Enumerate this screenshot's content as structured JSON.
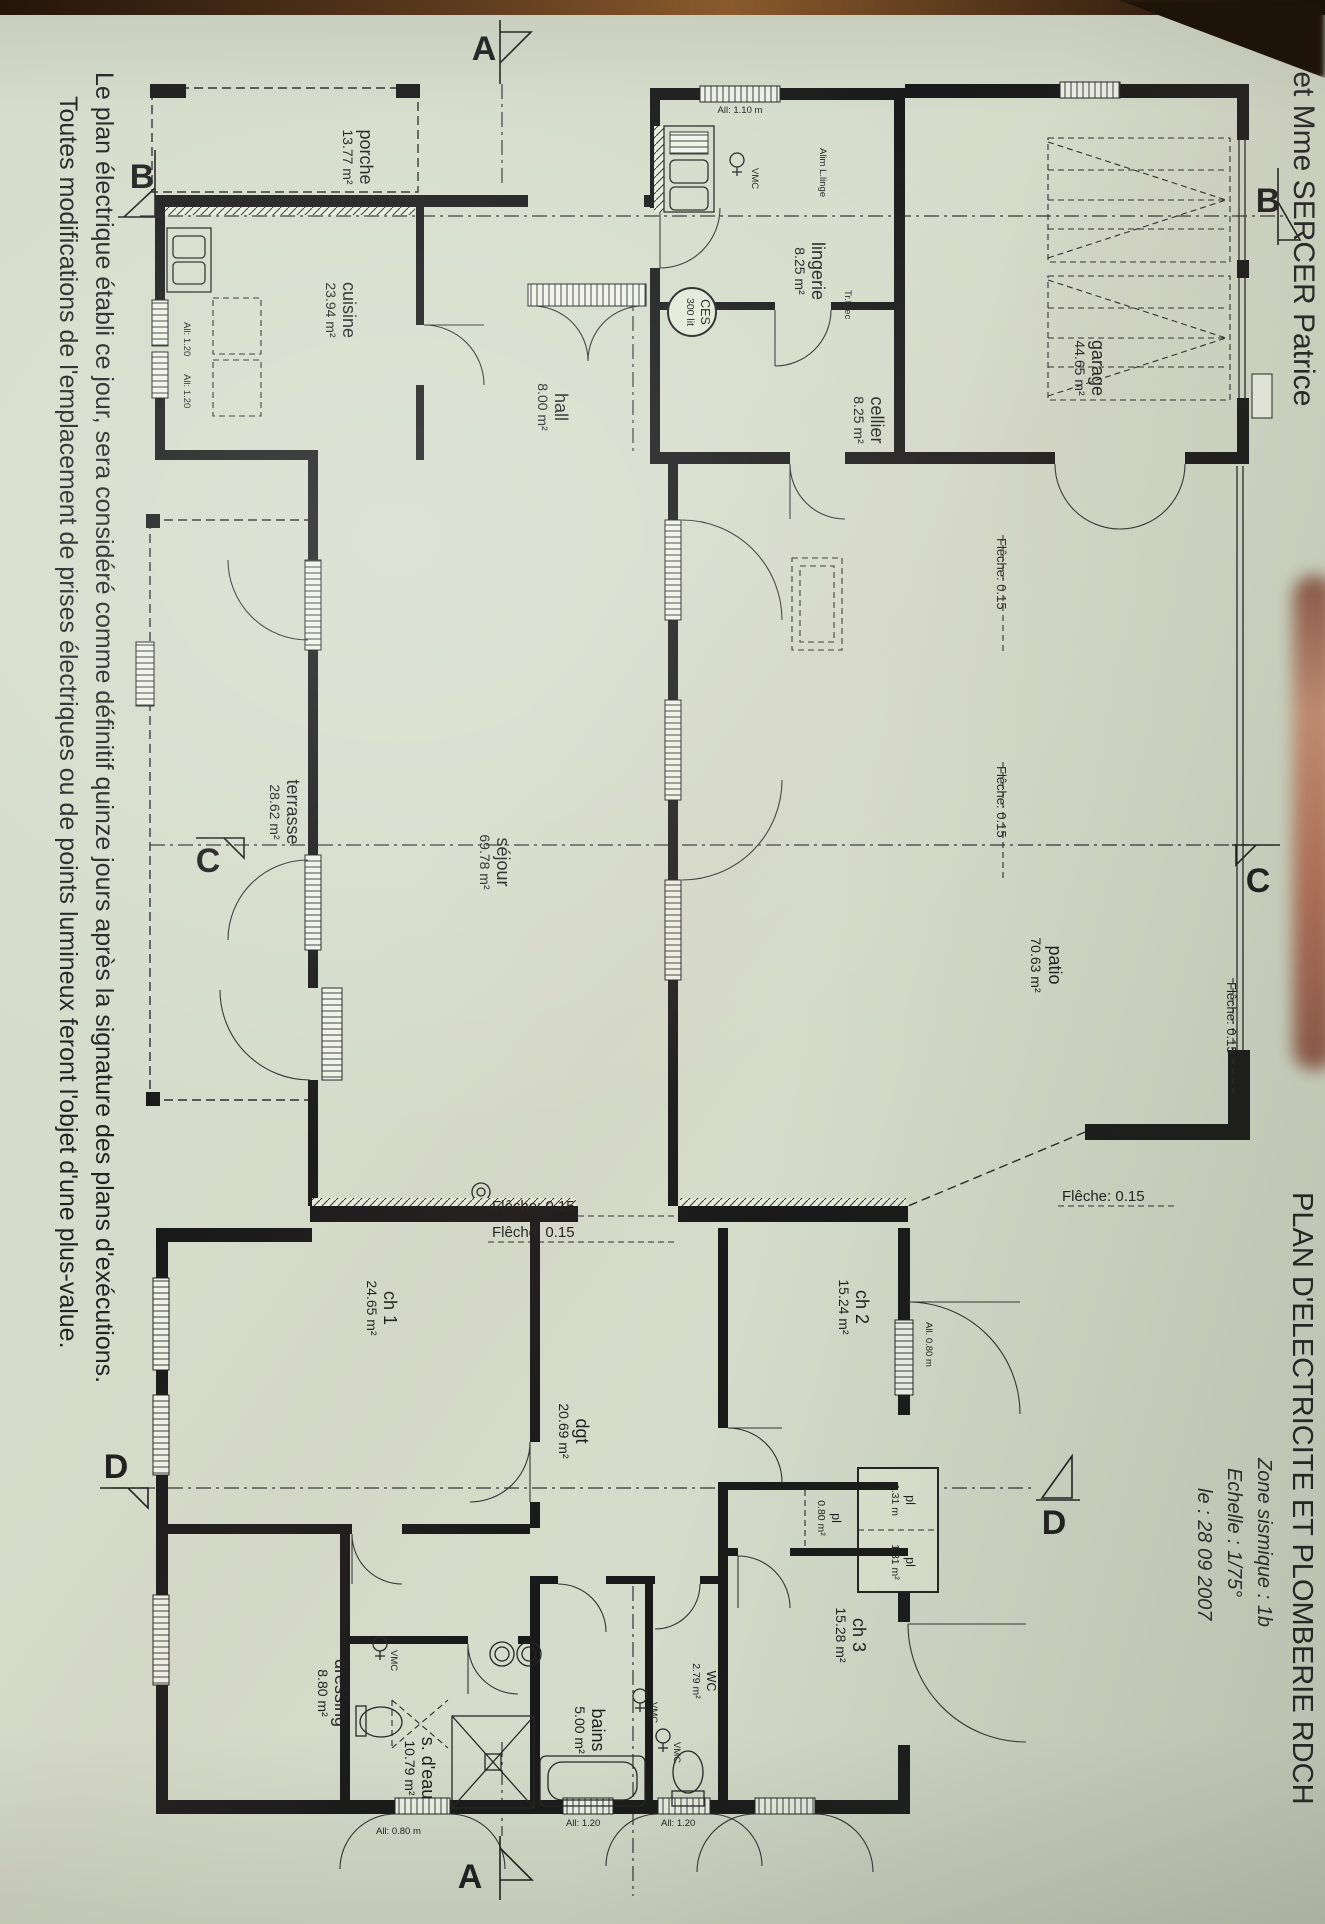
{
  "photo": {
    "paper_color": "#d6dccb",
    "table_color": "#3a2412",
    "finger_color": "#a85f46",
    "ink_color": "#1e1e1e"
  },
  "header": {
    "owner": "M et Mme SERCER Patrice",
    "title": "PLAN D'ELECTRICITE ET PLOMBERIE RDCH",
    "info_line1": "Zone sismique : 1b",
    "info_line2": "Echelle : 1/75°",
    "info_line3": "le : 28 09 2007"
  },
  "notes": {
    "line1": "Le plan électrique établi ce jour, sera considéré comme définitif quinze jours après la signature des plans d'exécutions.",
    "line2": "Toutes modifications de l'emplacement de prises électriques ou de points lumineux feront l'objet d'une plus-value."
  },
  "rooms": [
    {
      "id": "porche",
      "name": "porche",
      "area": "13.77 m²"
    },
    {
      "id": "cuisine",
      "name": "cuisine",
      "area": "23.94 m²"
    },
    {
      "id": "hall",
      "name": "hall",
      "area": "8.00 m²"
    },
    {
      "id": "lingerie",
      "name": "lingerie",
      "area": "8.25 m²"
    },
    {
      "id": "cellier",
      "name": "cellier",
      "area": "8.25 m²"
    },
    {
      "id": "garage",
      "name": "garage",
      "area": "44.65 m²"
    },
    {
      "id": "terrasse",
      "name": "terrasse",
      "area": "28.62 m²"
    },
    {
      "id": "sejour",
      "name": "séjour",
      "area": "69.78 m²"
    },
    {
      "id": "patio",
      "name": "patio",
      "area": "70.63 m²"
    },
    {
      "id": "ch1",
      "name": "ch 1",
      "area": "24.65 m²"
    },
    {
      "id": "dgt",
      "name": "dgt",
      "area": "20.69 m²"
    },
    {
      "id": "ch2",
      "name": "ch 2",
      "area": "15.24 m²"
    },
    {
      "id": "pl080",
      "name": "pl",
      "area": "0.80 m²"
    },
    {
      "id": "pl131a",
      "name": "pl",
      "area": "1.31 m"
    },
    {
      "id": "pl131b",
      "name": "pl",
      "area": "1.31 m²"
    },
    {
      "id": "ch3",
      "name": "ch 3",
      "area": "15.28 m²"
    },
    {
      "id": "wc",
      "name": "WC",
      "area": "2.79 m²"
    },
    {
      "id": "bains",
      "name": "bains",
      "area": "5.00 m²"
    },
    {
      "id": "sdeau",
      "name": "s. d'eau",
      "area": "10.79 m²"
    },
    {
      "id": "dressing",
      "name": "dressing",
      "area": "8.80 m²"
    }
  ],
  "annotations": {
    "fleche": "Flêche: 0.15",
    "vmc": "VMC",
    "alim_linge": "Alim L.linge",
    "tr_elec": "Tr.Elec",
    "ces_line1": "CES",
    "ces_line2": "300 lit",
    "allege_110": "All: 1.10 m",
    "allege_120": "All: 1.20",
    "allege_080": "All: 0.80 m",
    "allege_080_alt": "All. 0.80 m"
  },
  "sections": {
    "a": "A",
    "b": "B",
    "c": "C",
    "d": "D"
  }
}
